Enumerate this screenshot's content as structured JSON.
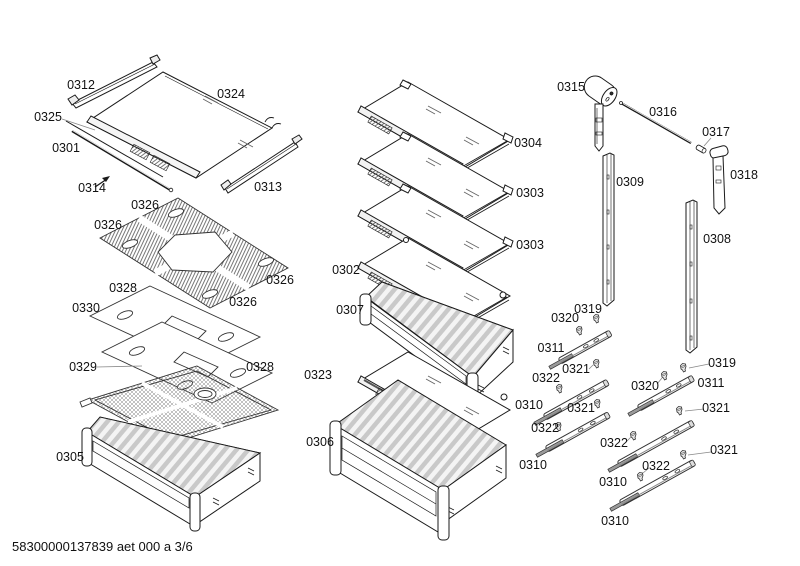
{
  "page": {
    "background": "#ffffff",
    "line_color": "#1a1a1a"
  },
  "footer": {
    "doc_code": "58300000137839 aet 000 a 3/6"
  },
  "parts_visible": [
    "0301",
    "0302",
    "0303",
    "0304",
    "0305",
    "0306",
    "0307",
    "0308",
    "0309",
    "0310",
    "0311",
    "0312",
    "0313",
    "0314",
    "0315",
    "0316",
    "0317",
    "0318",
    "0319",
    "0320",
    "0321",
    "0322",
    "0323",
    "0324",
    "0325",
    "0326",
    "0328",
    "0329",
    "0330"
  ],
  "callouts": [
    {
      "text": "0312"
    },
    {
      "text": "0324"
    },
    {
      "text": "0325"
    },
    {
      "text": "0301"
    },
    {
      "text": "0314"
    },
    {
      "text": "0313"
    },
    {
      "text": "0326"
    },
    {
      "text": "0326"
    },
    {
      "text": "0326"
    },
    {
      "text": "0326"
    },
    {
      "text": "0328"
    },
    {
      "text": "0330"
    },
    {
      "text": "0329"
    },
    {
      "text": "0328"
    },
    {
      "text": "0305"
    },
    {
      "text": "0323"
    },
    {
      "text": "0306"
    },
    {
      "text": "0302"
    },
    {
      "text": "0307"
    },
    {
      "text": "0304"
    },
    {
      "text": "0303"
    },
    {
      "text": "0303"
    },
    {
      "text": "0315"
    },
    {
      "text": "0316"
    },
    {
      "text": "0317"
    },
    {
      "text": "0318"
    },
    {
      "text": "0309"
    },
    {
      "text": "0308"
    },
    {
      "text": "0319"
    },
    {
      "text": "0320"
    },
    {
      "text": "0311"
    },
    {
      "text": "0321"
    },
    {
      "text": "0322"
    },
    {
      "text": "0310"
    },
    {
      "text": "0321"
    },
    {
      "text": "0322"
    },
    {
      "text": "0310"
    },
    {
      "text": "0319"
    },
    {
      "text": "0320"
    },
    {
      "text": "0311"
    },
    {
      "text": "0321"
    },
    {
      "text": "0322"
    },
    {
      "text": "0310"
    },
    {
      "text": "0322"
    },
    {
      "text": "0321"
    },
    {
      "text": "0310"
    }
  ]
}
